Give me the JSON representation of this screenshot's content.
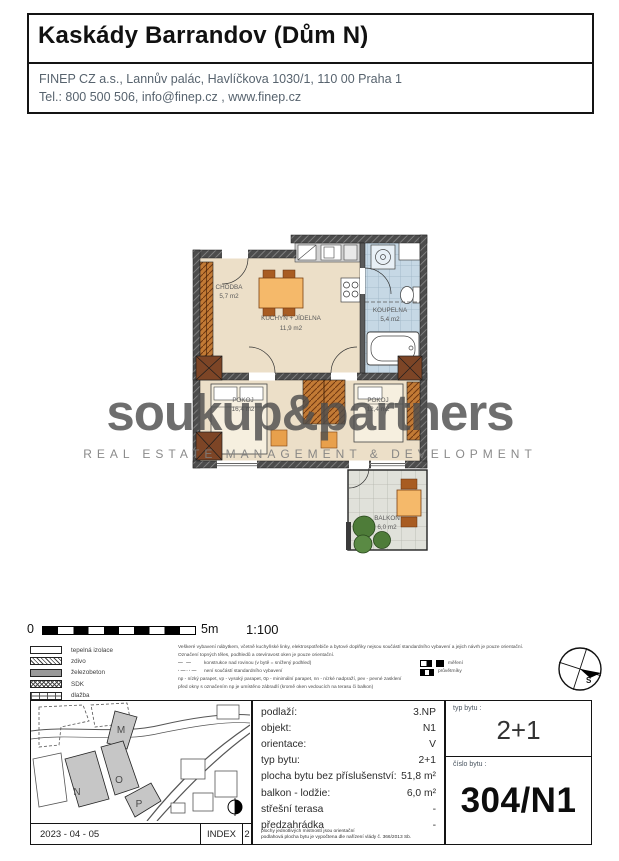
{
  "header": {
    "title": "Kaskády Barrandov (Dům N)",
    "address_line": "FINEP CZ a.s., Lannův palác, Havlíčkova 1030/1, 110 00 Praha 1",
    "contact_line": "Tel.: 800 500 506,  info@finep.cz , www.finep.cz"
  },
  "watermark": {
    "name": "soukup&partners",
    "tagline": "REAL ESTATE MANAGEMENT & DEVELOPMENT"
  },
  "floorplan": {
    "rooms": [
      {
        "name": "CHODBA",
        "area": "5,7 m2"
      },
      {
        "name": "KUCHYŇ + JÍDELNA",
        "area": "11,9 m2"
      },
      {
        "name": "KOUPELNA",
        "area": "5,4 m2"
      },
      {
        "name": "POKOJ",
        "area": "16,4 m2"
      },
      {
        "name": "POKOJ",
        "area": "12,4 m2"
      },
      {
        "name": "BALKON",
        "area": "6,0 m2"
      }
    ]
  },
  "scale": {
    "start": "0",
    "end": "5m",
    "ratio": "1:100"
  },
  "legend": {
    "materials": [
      {
        "label": "tepelná izolace"
      },
      {
        "label": "zdivo"
      },
      {
        "label": "železobeton"
      },
      {
        "label": "SDK"
      },
      {
        "label": "dlažba"
      }
    ],
    "note1": "Veškeré vybavení nábytkem, včetně kuchyňské linky, elektrospotřebiče a bytové doplňky nejsou součástí standardního vybavení a jejich návrh je pouze orientační.",
    "note2": "Označení topných těles, podhledů a otevíravost oken je pouze orientační.",
    "sym1_dash": "— —",
    "sym1_label": "konstrukce nad rovinou    (v bytě = snížený podhled)",
    "sym1_right": "měření",
    "sym2_dash": "·—··—",
    "sym2_label": "není součástí standardního vybavení",
    "sym2_right": "průvětrníky",
    "note3": "np - nízký parapet, vp - vysoký parapet, 0p - minimální parapet, nn - nízké nadpraží, pev - pevné zasklení",
    "note4": "před okny s označením np je umístěno zábradlí (kromě oken vedoucích na terasu či balkon)",
    "compass_label": "S"
  },
  "siteplan": {
    "buildings": {
      "m": "M",
      "n": "N",
      "o": "O",
      "p": "P"
    },
    "date": "2023 - 04 - 05",
    "index_label": "INDEX",
    "index_value": "2"
  },
  "details": {
    "rows": [
      {
        "label": "podlaží:",
        "value": "3.NP"
      },
      {
        "label": "objekt:",
        "value": "N1"
      },
      {
        "label": "orientace:",
        "value": "V"
      },
      {
        "label": "typ bytu:",
        "value": "2+1"
      },
      {
        "label": "plocha bytu bez příslušenství:",
        "value": "51,8 m²"
      },
      {
        "label": "balkon - lodžie:",
        "value": "6,0 m²"
      },
      {
        "label": "střešní terasa",
        "value": "-"
      },
      {
        "label": "předzahrádka",
        "value": "-"
      }
    ],
    "footnote1": "plochy jednotlivých místností jsou orientační",
    "footnote2": "podlahová plocha bytu je vypočtena dle nařízení vlády č. 366/2013 Sb."
  },
  "unit": {
    "type_label": "typ bytu :",
    "type_value": "2+1",
    "number_label": "číslo bytu :",
    "number_value": "304/N1"
  }
}
